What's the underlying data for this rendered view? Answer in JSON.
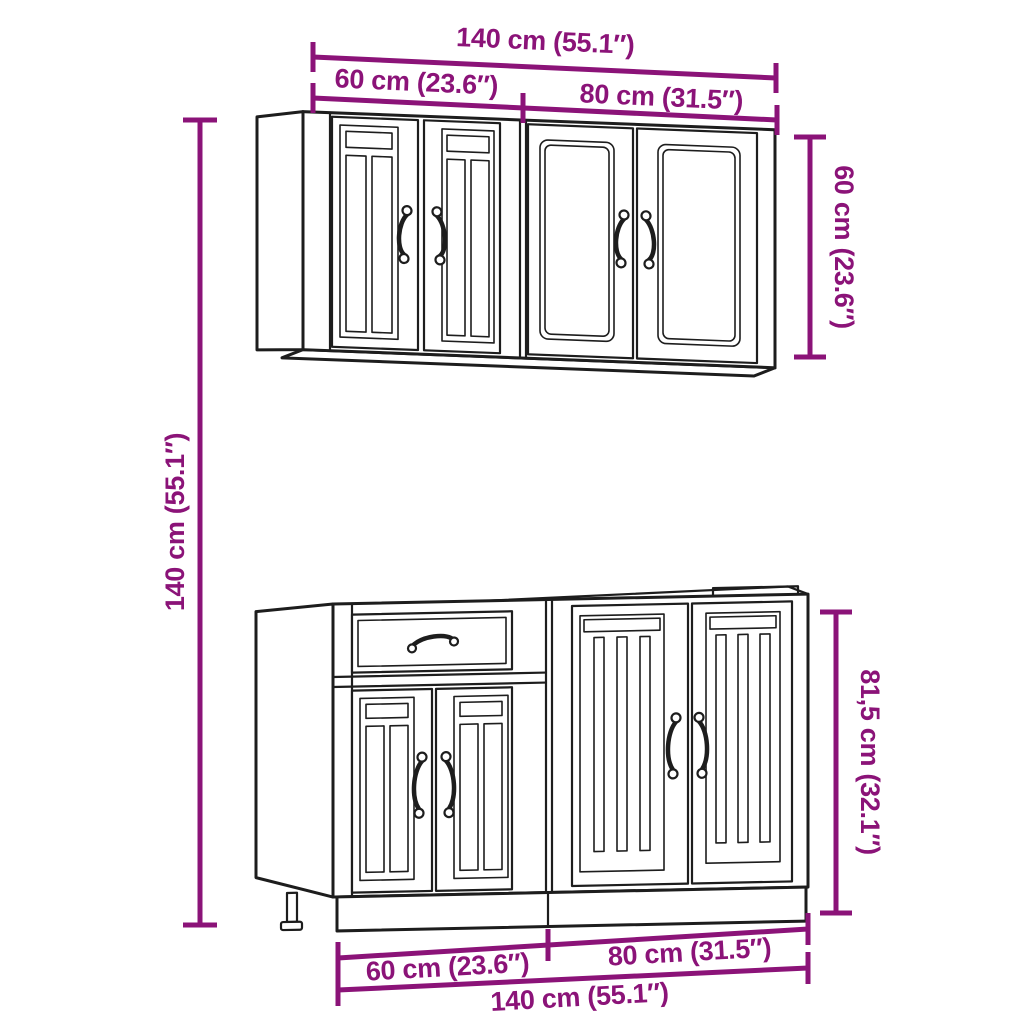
{
  "diagram": {
    "title": "kitchen-cabinet-set-dimensions",
    "background_color": "#ffffff",
    "dimension_color": "#8B1378",
    "line_color": "#1d1d1d",
    "annotations": {
      "top_total": "140 cm (55.1″)",
      "top_left": "60 cm (23.6″)",
      "top_right": "80 cm (31.5″)",
      "wall_height": "60 cm (23.6″)",
      "overall_height": "140 cm (55.1″)",
      "base_height": "81,5 cm (32.1″)",
      "bottom_left": "60 cm (23.6″)",
      "bottom_right": "80 cm (31.5″)",
      "bottom_total": "140 cm (55.1″)"
    }
  }
}
